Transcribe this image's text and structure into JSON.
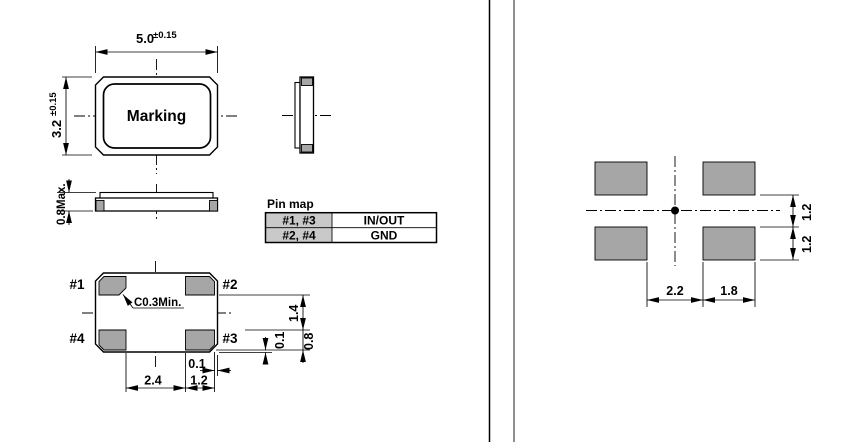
{
  "views": {
    "top": {
      "width": "5.0",
      "width_tol": "±0.15",
      "height": "3.2",
      "height_tol": "±0.15",
      "marking": "Marking"
    },
    "front": {
      "max_height": "0.8Max."
    },
    "pin_map": {
      "title": "Pin map",
      "rows": [
        {
          "pins": "#1, #3",
          "signal": "IN/OUT"
        },
        {
          "pins": "#2, #4",
          "signal": "GND"
        }
      ]
    },
    "bottom": {
      "pads": {
        "p1": "#1",
        "p2": "#2",
        "p3": "#3",
        "p4": "#4"
      },
      "chamfer_note": "C0.3Min.",
      "dims": {
        "pad_span": "2.4",
        "pad_width": "1.2",
        "edge_gap_x": "0.1",
        "pad_gap_y": "1.4",
        "pad_height": "0.8",
        "edge_gap_y": "0.1"
      }
    },
    "land_pattern": {
      "dims": {
        "gap_x": "2.2",
        "pad_width": "1.8",
        "gap_y": "1.2",
        "pad_height": "1.2"
      }
    }
  },
  "colors": {
    "pad_fill": "#a6a6a6",
    "table_header_fill": "#c9c9c9",
    "line": "#000000",
    "page_edge": "#8f8f8f",
    "background": "#ffffff"
  }
}
